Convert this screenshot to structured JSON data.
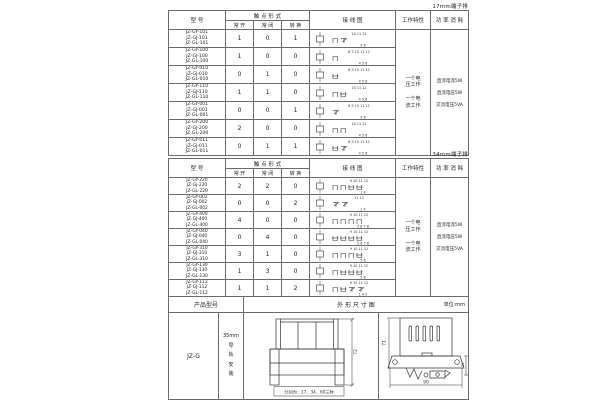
{
  "headers": {
    "model": "型 号",
    "contact": "触 点 形 式",
    "no": "常 开",
    "nc": "常 闭",
    "co": "转 换",
    "wiring": "接 线 图",
    "charact": "工作特性",
    "power": "功 率 消 耗"
  },
  "tables": [
    {
      "label": "17mm端子排",
      "charact1": "一个电\n压工作",
      "charact2": "一个电\n流工作",
      "power1": "直流电流5W",
      "power2": "直流电压5W",
      "power3": "交流电压5VA",
      "rows": [
        {
          "models": "JZ-GY-101\nJZ-GJ-101\nJZ-GL-101",
          "no": "1",
          "nc": "0",
          "co": "1",
          "top": "10 11 12",
          "bottom": "5 6"
        },
        {
          "models": "JZ-GY-100\nJZ-GJ-100\nJZ-GL-100",
          "no": "1",
          "nc": "0",
          "co": "0",
          "top": "8 9 10 11 12",
          "bottom": "4 5 6"
        },
        {
          "models": "JZ-GY-010\nJZ-GJ-010\nJZ-GL-010",
          "no": "0",
          "nc": "1",
          "co": "0",
          "top": "8 9 10 11 12",
          "bottom": "4 5 6"
        },
        {
          "models": "JZ-GY-110\nJZ-GJ-110\nJZ-GL-110",
          "no": "1",
          "nc": "1",
          "co": "0",
          "top": "10 11 12",
          "bottom": "4 5 6"
        },
        {
          "models": "JZ-GY-001\nJZ-GJ-001\nJZ-GL-001",
          "no": "0",
          "nc": "0",
          "co": "1",
          "top": "8 9 10 11 12",
          "bottom": "5 6"
        },
        {
          "models": "JZ-GY-200\nJZ-GJ-200\nJZ-GL-200",
          "no": "2",
          "nc": "0",
          "co": "0",
          "top": "10 11 12",
          "bottom": "4 5 6"
        },
        {
          "models": "JZ-GY-011\nJZ-GJ-011\nJZ-GL-011",
          "no": "0",
          "nc": "1",
          "co": "1",
          "top": "8 9 10 11 12",
          "bottom": "4 5 6"
        }
      ]
    },
    {
      "label": "34mm端子排",
      "charact1": "一个电\n压工作",
      "charact2": "一个电\n流工作",
      "power1": "直流电流5W",
      "power2": "直流电压5W",
      "power3": "交流电压5VA",
      "rows": [
        {
          "models": "JZ-GY-220\nJZ-GJ-220\nJZ-GL-220",
          "no": "2",
          "nc": "2",
          "co": "0",
          "top": "9 10 11 12",
          "bottom": "1 4"
        },
        {
          "models": "JZ-GY-002\nJZ-GJ-002\nJZ-GL-002",
          "no": "0",
          "nc": "0",
          "co": "2",
          "top": "11 12",
          "bottom": "1 4"
        },
        {
          "models": "JZ-GY-400\nJZ-GJ-400\nJZ-GL-400",
          "no": "4",
          "nc": "0",
          "co": "0",
          "top": "9 10 11 12",
          "bottom": "5 6 7 8"
        },
        {
          "models": "JZ-GY-040\nJZ-GJ-040\nJZ-GL-040",
          "no": "0",
          "nc": "4",
          "co": "0",
          "top": "9 10 11 12",
          "bottom": "5 6 7 8"
        },
        {
          "models": "JZ-GY-310\nJZ-GJ-310\nJZ-GL-310",
          "no": "3",
          "nc": "1",
          "co": "0",
          "top": "9 10 11 12",
          "bottom": "5 6"
        },
        {
          "models": "JZ-GY-130\nJZ-GJ-130\nJZ-GL-130",
          "no": "1",
          "nc": "3",
          "co": "0",
          "top": "9 10 11 12",
          "bottom": "5 6"
        },
        {
          "models": "JZ-GY-112\nJZ-GJ-112\nJZ-GL-112",
          "no": "1",
          "nc": "1",
          "co": "2",
          "top": "9 10 11 12",
          "bottom": "1 4 5"
        }
      ]
    }
  ],
  "bottom": {
    "header_model": "产品型号",
    "header_dim": "外 形 尺 寸 图",
    "header_unit": "单位:mm",
    "model": "JZ-G",
    "mount": "35mm\n导\n轨\n安\n装",
    "note": "分别为：17、34、60三种",
    "front_height": "72",
    "side_height": "71",
    "side_width": "90",
    "rail_height": "35"
  }
}
